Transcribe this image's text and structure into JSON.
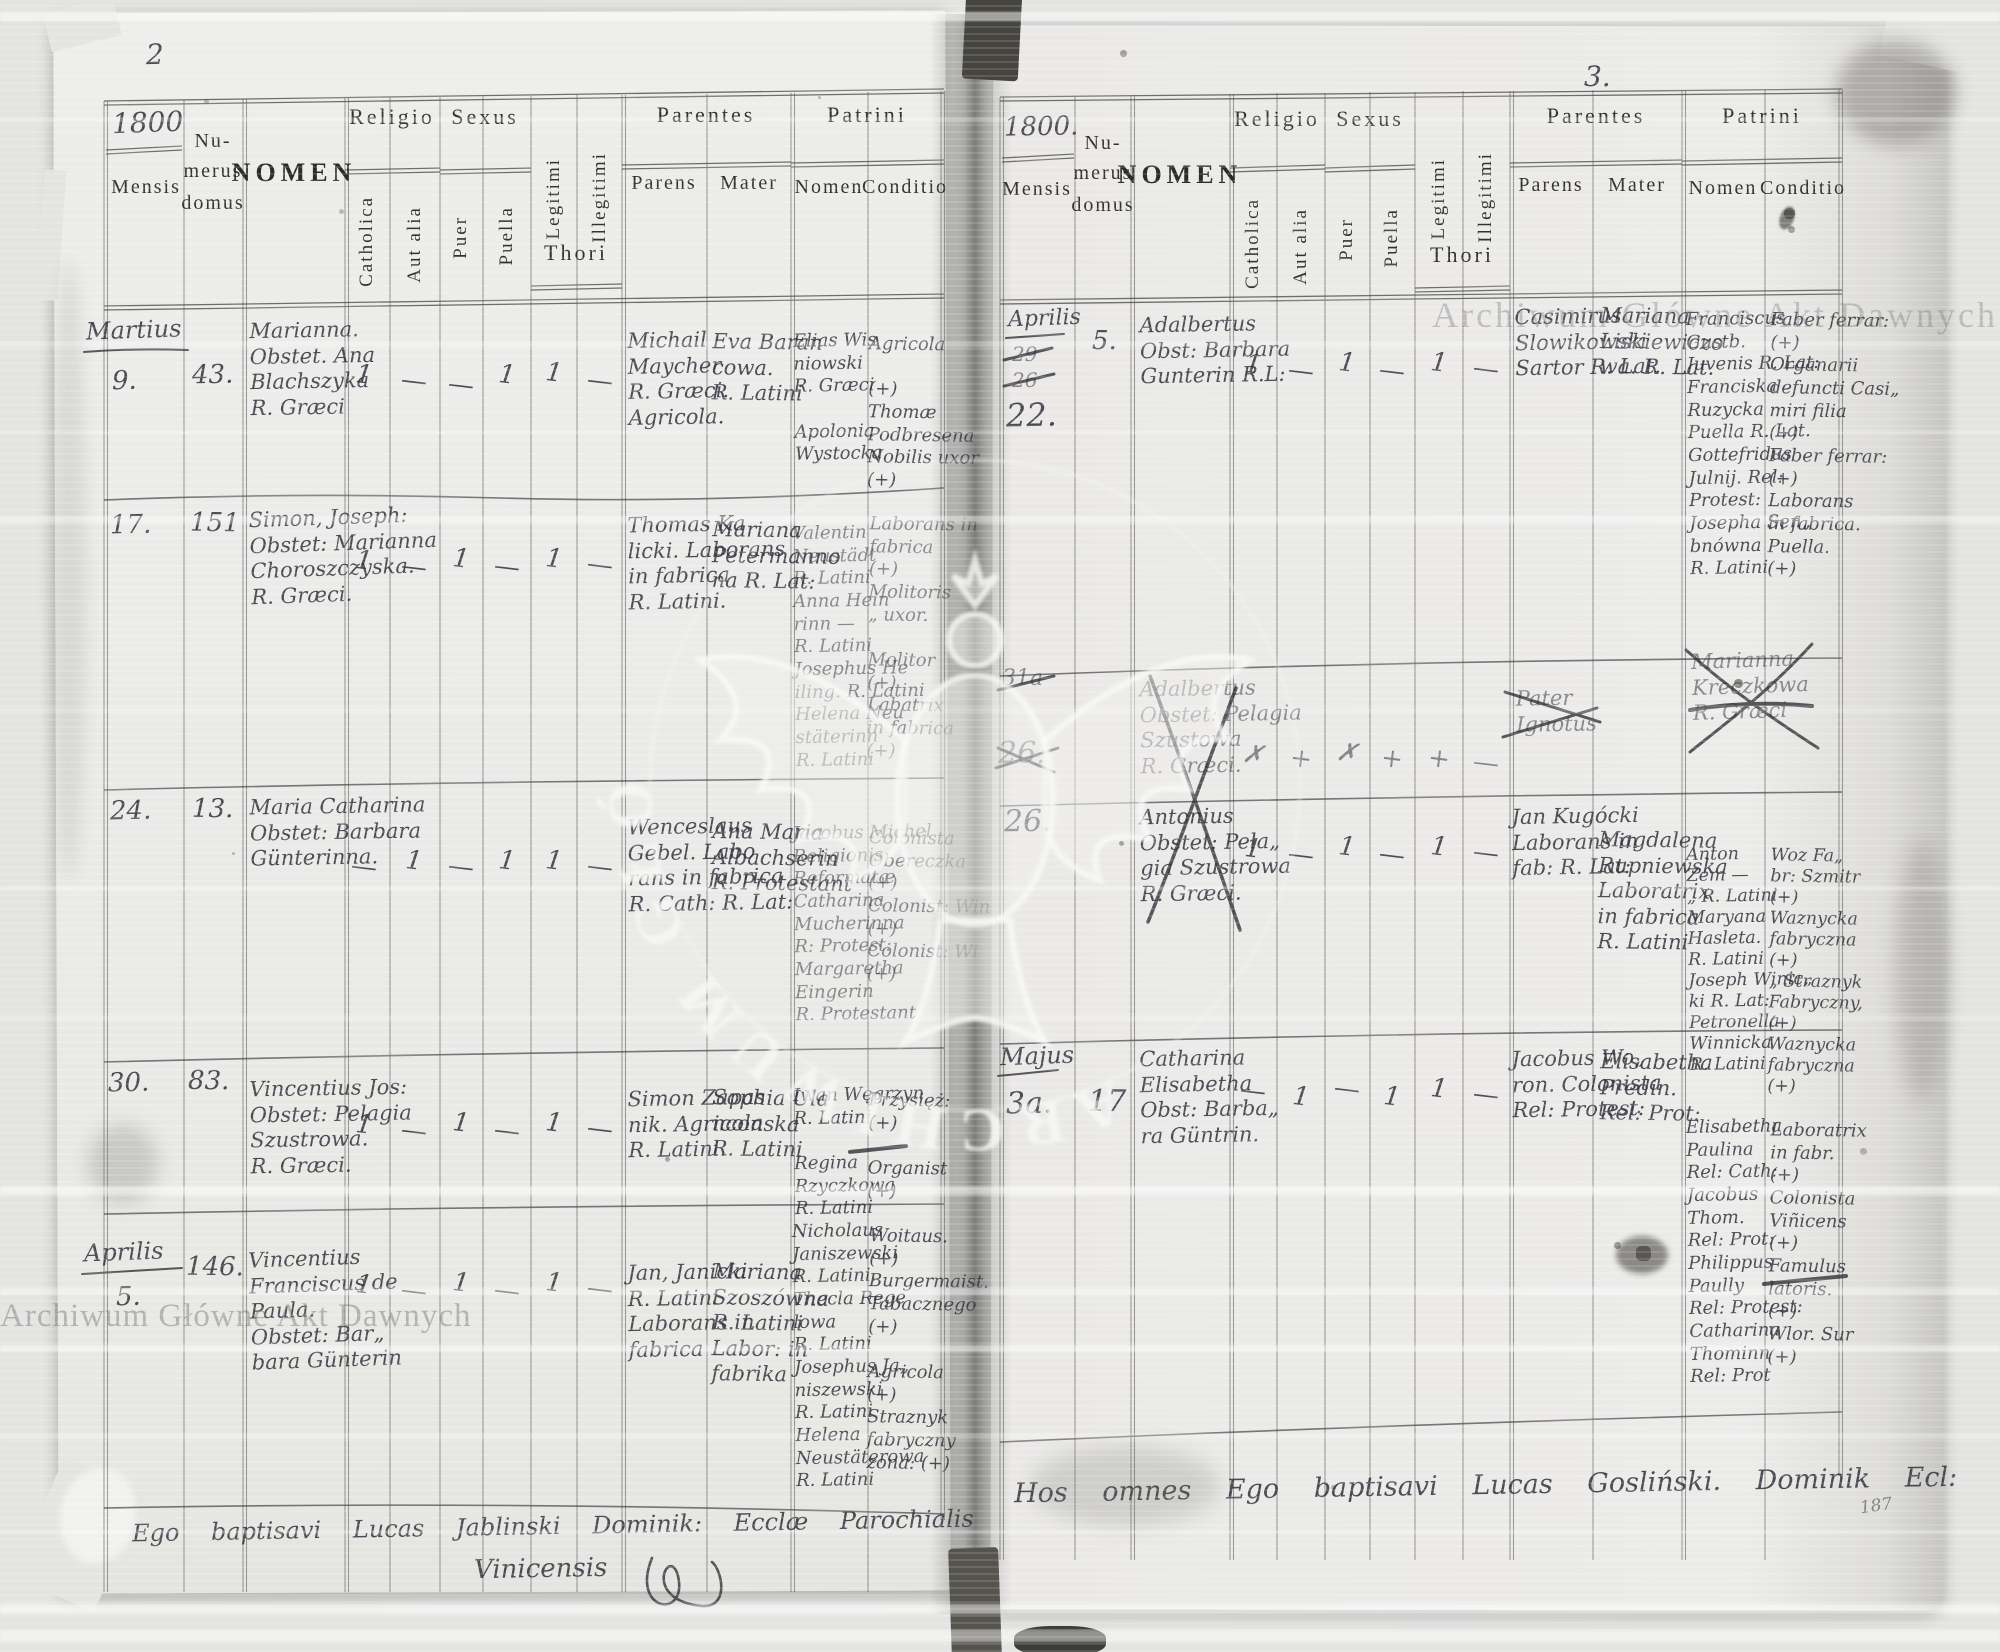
{
  "scan": {
    "left_page_number": "2",
    "right_page_number": "3.",
    "watermark_arc": "ARCHIWUM GŁÓWNE AKT DAWNYCH",
    "watermark_corner": "Archiwum Główne Akt Dawnych",
    "watermark_bottom": "Archiwum Główne Akt Dawnych"
  },
  "labels": {
    "mensis": "Mensis",
    "nu": "Nu-",
    "merus": "merus",
    "domus": "domus",
    "nomen": "NOMEN",
    "religio": "Religio",
    "sexus": "Sexus",
    "catholica": "Catholica",
    "aut_alia": "Aut alia",
    "puer": "Puer",
    "puella": "Puella",
    "legitimi": "Legitimi",
    "illegitimi": "Illegitimi",
    "thori": "Thori",
    "parentes": "Parentes",
    "parens": "Parens",
    "mater": "Mater",
    "patrini": "Patrini",
    "patrini_nomen": "Nomen",
    "conditio": "Conditio"
  },
  "left_page": {
    "year": "1800",
    "rows": [
      {
        "month": "Martius",
        "day": "9.",
        "domus": "43.",
        "nomen": "Marianna.\nObstet. Ana\nBlachszyka\nR. Græci",
        "m_cath": "1",
        "m_aut": "—",
        "m_puer": "—",
        "m_puella": "1",
        "m_leg": "1",
        "m_illeg": "—",
        "parens": "Michail\nMaycher\nR. Græci.\nAgricola.",
        "mater": "Eva Baran\ncowa.\nR. Latini",
        "p_nomen": "Elias Wis\nniowski\nR. Græci\n\nApolonia\nWystocka",
        "p_cond": "Agricola\n\n(+)\nThomæ\nPodbresena\nNobilis uxor\n(+)"
      },
      {
        "day": "17.",
        "domus": "151",
        "nomen": "Simon, Joseph:\nObstet: Marianna\nChoroszczyska.\nR. Græci.",
        "m_cath": "1",
        "m_aut": "—",
        "m_puer": "1",
        "m_puella": "—",
        "m_leg": "1",
        "m_illeg": "—",
        "parens": "Thomas Ka\nlicki. Laborans\nin fabrica\nR. Latini.",
        "mater": "Mariana\nPetermanno\nna R. Lat:",
        "p_nomen": "Valentin\nNeustädt\nR. Latini\nAnna Hein\nrinn —\nR. Latini\nJosephus He\niling. R. Latini\nHelena Neu\nstäterinn\nR. Latini",
        "p_cond": "Laborans in\nfabrica\n(+)\nMolitoris\n„ uxor.\n\nMolitor\n(+)\nLabatrix\nin fabrica\n(+)"
      },
      {
        "day": "24.",
        "domus": "13.",
        "nomen": "Maria Catharina\nObstet: Barbara\nGünterinna.",
        "m_cath": "—",
        "m_aut": "1",
        "m_puer": "—",
        "m_puella": "1",
        "m_leg": "1",
        "m_illeg": "—",
        "parens": "Wenceslaus\nGebel. Labo\nrans in fabrica\nR. Cath: R. Lat:",
        "mater": "Ana Maria\nAlbachserin\nR. Protestant",
        "p_nomen": "Jacobus Michel\nReligionis\nReformatæ\nCatharina\nMucherinna\nR: Protest:\nMargaretha\nEingerin\nR. Protestant",
        "p_cond": "Colonista\nObereczka\n(+)\nColonist: Win\n(+)\nColonist: Wi\n(+)"
      },
      {
        "day": "30.",
        "domus": "83.",
        "nomen": "Vincentius Jos:\nObstet: Pelagia\nSzustrowa.\nR. Græci.",
        "m_cath": "1",
        "m_aut": "—",
        "m_puer": "1",
        "m_puella": "—",
        "m_leg": "1",
        "m_illeg": "—",
        "parens": "Simon Zapas\nnik. Agricola\nR. Latini.",
        "mater": "Sophia Ula\nnconska\nR. Latini",
        "p_nomen": "Iwan Węgrzyn\nR. Latini\n\nRegina\nRzyczkowa\nR. Latini",
        "p_cond": "Przysięż:\n(+)\n\nOrganist\n(+)"
      },
      {
        "month": "Aprilis",
        "day": "5.",
        "domus": "146.",
        "nomen": "Vincentius\nFranciscus de\nPaula.\nObstet: Bar„\nbara Günterin",
        "m_cath": "1",
        "m_aut": "—",
        "m_puer": "1",
        "m_puella": "—",
        "m_leg": "1",
        "m_illeg": "—",
        "parens": "Jan, Janicki\nR. Latini\nLaborans in\nfabrica",
        "mater": "Mariana\nSzoszówna\nR. Latini\nLabor: in\nfabrika",
        "p_nomen": "Nicholaus\nJaniszewski\nR. Latini.\nThecla Rege\nlowa\nR. Latini\nJosephus Ja„\nniszewski\nR. Latini\nHelena\nNeustäterowa\nR. Latini",
        "p_cond": "Woitaus.\n(+)\nBurgermaist.\nTabacznego\n(+)\n\nAgricola\n(+)\nStraznyk\nfabryczny\nzona: (+)"
      }
    ],
    "footer_line": "Ego baptisavi Lucas Jablinski Dominik: Ecclæ Parochialis",
    "footer_line2": "Vinicensis"
  },
  "right_page": {
    "year": "1800.",
    "rows": [
      {
        "month": "Aprilis",
        "day_struck1": "29",
        "day_struck2": "26",
        "day": "22.",
        "domus": "5.",
        "nomen": "Adalbertus\nObst: Barbara\nGunterin R.L:",
        "m_cath": "1",
        "m_aut": "—",
        "m_puer": "1",
        "m_puella": "—",
        "m_leg": "1",
        "m_illeg": "—",
        "parens": "Casimirus\nSlowikowski\nSartor R. Lat.",
        "mater": "Mariana\nLiskiewiczo\nwa. R. Lat.",
        "p_nomen": "Franciscus\nGustb.\nJuvenis R. Lat:\nFranciska\nRuzycka\nPuella R. Lat.\nGottefridus\nJulnij. Rel:\nProtest:\nJosepha Sen„\nbnówna\nR. Latini",
        "p_cond": "Faber ferrar:\n(+)\nOrganarii\ndefuncti Casi„\nmiri filia\n(+)\nFaber ferrar:\n(+)\nLaborans\nin fabrica.\nPuella.\n(+)"
      },
      {
        "day_struck1": "31a",
        "day_struck2": "26.",
        "nomen": "Adalbertus\nObstet: Pelagia\nSzustowa\nR. Græci.",
        "m_cath": "✗",
        "m_aut": "+",
        "m_puer": "✗",
        "m_puella": "+",
        "m_leg": "+",
        "m_illeg": "—",
        "parens": "Pater\nIgnotus",
        "mater": "Marianna\nKreczkowa\nR. Græci"
      },
      {
        "day": "26.",
        "nomen": "Antonius\nObstet: Pela„\ngia Szustrowa\nR. Græci.",
        "m_cath": "1",
        "m_aut": "—",
        "m_puer": "1",
        "m_puella": "—",
        "m_leg": "1",
        "m_illeg": "—",
        "parens": "Jan Kugócki\nLaborans in\nfab: R. Lat:",
        "mater": "Magdalena\nRupniewska\nLaboratrix\nin fabrica\nR. Latini",
        "p_nomen": "Anton\nZem —\n„ R. Latini\nMaryana\nHasleta.\nR. Latini\nJoseph Winic„\nki R. Lat:\nPetronella\nWinnicka\nR. Latini",
        "p_cond": "Woz Fa„\nbr: Szmitr\n(+)\nWaznycka\nfabryczna\n(+)\n„ Straznyk\nFabryczny,\n(+)\nWaznycka\nfabryczna\n(+)"
      },
      {
        "month": "Majus",
        "day": "3a.",
        "domus": "17",
        "nomen": "Catharina\nElisabetha\nObst: Barba„\nra Güntrin.",
        "m_cath": "—",
        "m_aut": "1",
        "m_puer": "—",
        "m_puella": "1",
        "m_leg": "1",
        "m_illeg": "—",
        "parens": "Jacobus Wo„\nron. Colonista\nRel: Protest:",
        "mater": "Elisabetha\nPredin.\nRel: Prot:",
        "p_nomen": "Elisabetha\nPaulina\nRel: Cath:\nJacobus\nThom.\nRel: Prot:\nPhilippus\nPaully\nRel: Protest:\nCatharina\nThominn\nRel: Prot",
        "p_cond": "Laboratrix\nin fabr.\n(+)\nColonista\nViñicens\n(+)\nFamulus\nlatoris.\n(+)\nWlor. Sur\n(+)"
      }
    ],
    "footer_line": "Hos omnes Ego baptisavi Lucas Gosliński. Dominik Ecl:",
    "footer_mark": "187"
  }
}
